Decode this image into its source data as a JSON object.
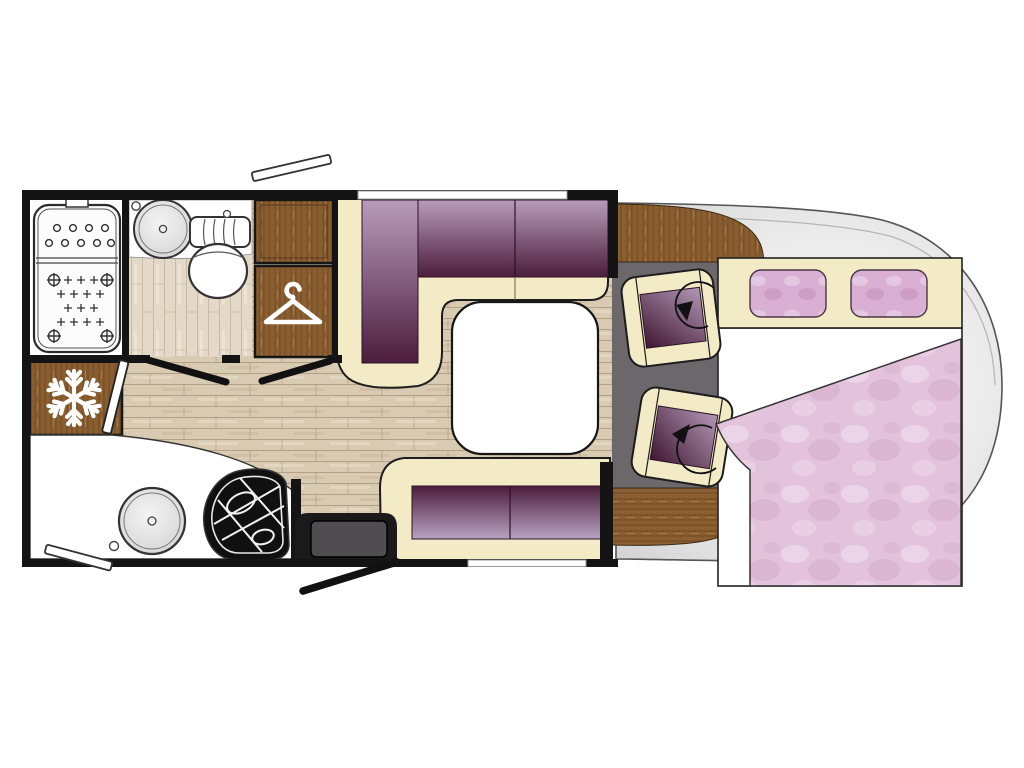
{
  "diagram": {
    "type": "motorhome-floorplan-top-view",
    "orientation": "cab-on-right",
    "rooms": [
      {
        "name": "bathroom",
        "fixtures": [
          "shower-tray",
          "washbasin",
          "toilet"
        ]
      },
      {
        "name": "wardrobe-column",
        "fixtures": [
          "overhead-cabinet",
          "hanging-wardrobe"
        ]
      },
      {
        "name": "kitchen",
        "fixtures": [
          "refrigerator",
          "round-sink",
          "gas-hob",
          "worktop"
        ]
      },
      {
        "name": "entrance",
        "fixtures": [
          "entry-step",
          "open-entry-door"
        ]
      },
      {
        "name": "lounge",
        "fixtures": [
          "l-shaped-sofa",
          "dinette-table",
          "side-sofa"
        ]
      },
      {
        "name": "cab",
        "fixtures": [
          "swivel-seat-front",
          "swivel-seat-rear",
          "dashboard-trim",
          "rear-trim"
        ]
      },
      {
        "name": "bed-area",
        "fixtures": [
          "mattress",
          "pillow-left",
          "pillow-right",
          "sheet",
          "duvet"
        ]
      }
    ],
    "icons": [
      "snowflake-icon",
      "hanger-icon",
      "rotate-arrow-icon"
    ],
    "openings": [
      "top-window",
      "bottom-window",
      "top-open-window-flap",
      "bottom-open-window-flap",
      "bathroom-door",
      "interior-door-swings",
      "entry-door-swing"
    ]
  },
  "colors": {
    "wall": "#141414",
    "cream": "#f2ebc6",
    "creamLine": "#23201a",
    "purpleDark": "#4c1d3c",
    "purpleLight": "#b79cba",
    "sofaLight": "#b7a4c2",
    "cushionDark": "#3f1631",
    "cushionLight": "#b298b5",
    "wood": "#8a5e31",
    "woodDark": "#5f3f1c",
    "floor": "#d9cab2",
    "floorLine": "#bfae94",
    "bathFloor": "#e4d9c8",
    "bathFloorLine": "#d2c5b0",
    "cabFloor": "#6b676b",
    "body": "#e9e9e9",
    "bodyDeep": "#d2d2d2",
    "bodyStroke": "#555555",
    "white": "#ffffff",
    "duvet": "#e3c2dc",
    "duvetDeep": "#cfa6c6",
    "pillow": "#d9b0d4",
    "stepFill": "#4f4d4f",
    "ink": "#111111",
    "sinkGray": "#d8d8d8"
  }
}
